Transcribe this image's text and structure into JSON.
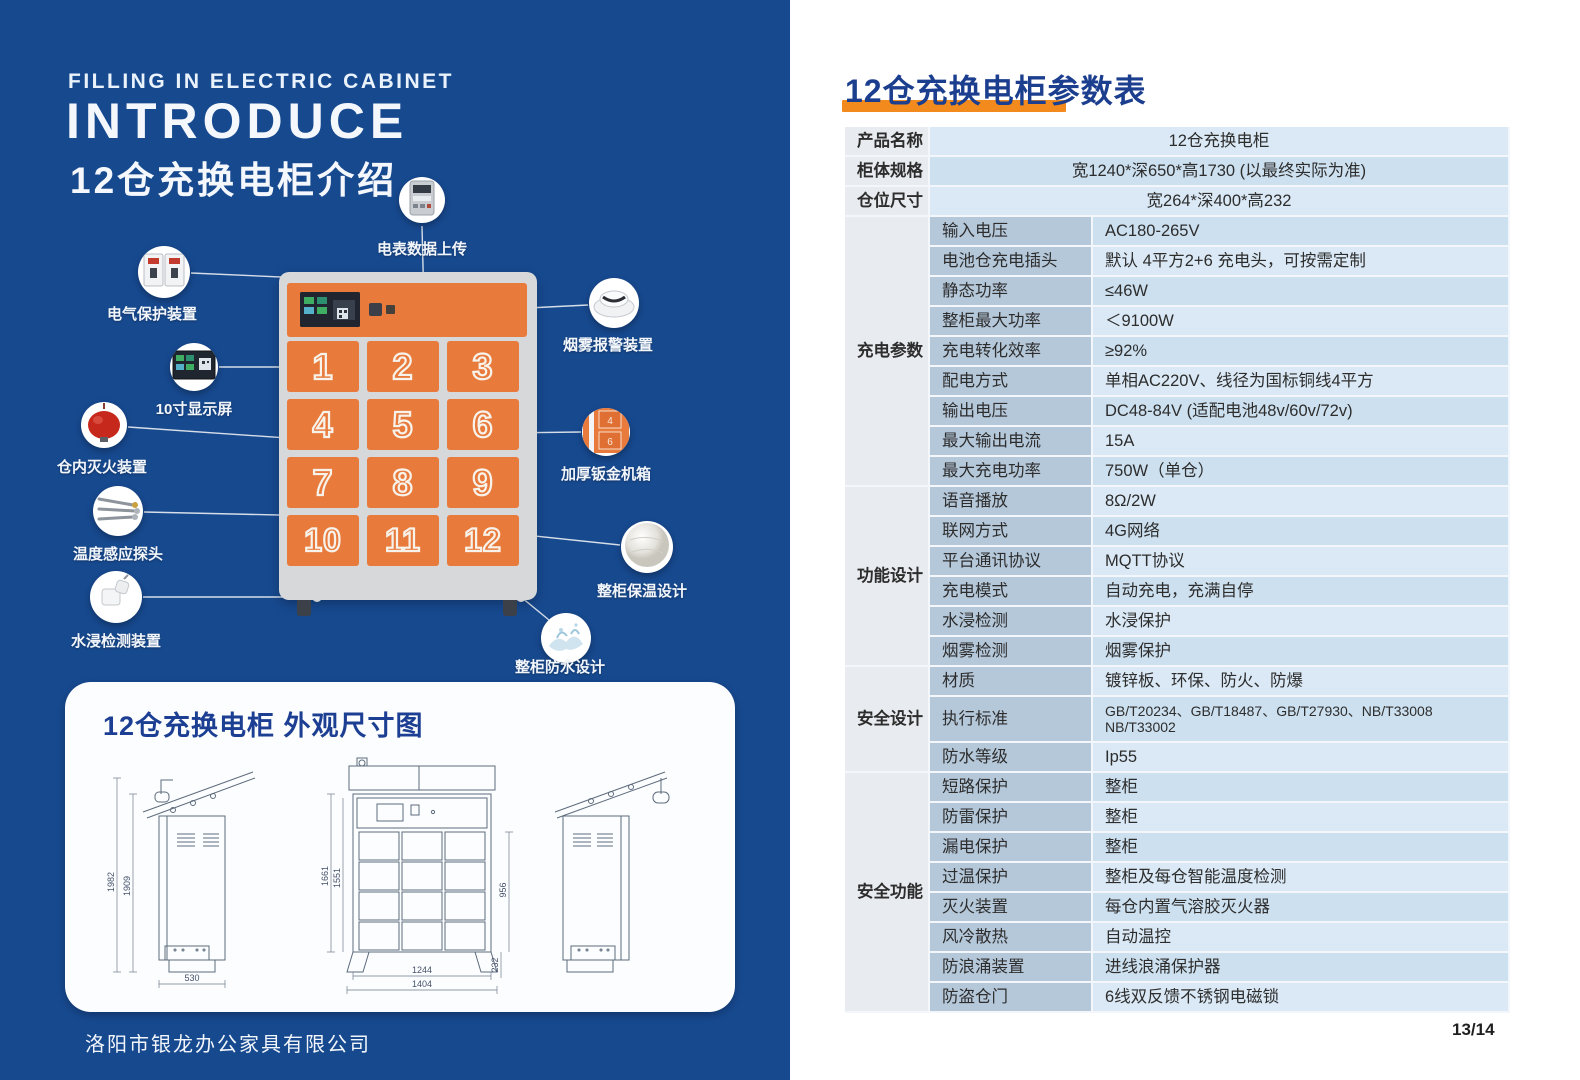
{
  "colors": {
    "panel_blue": "#17498f",
    "door_orange": "#e87a3c",
    "title_blue": "#1c3e8e",
    "underline_orange": "#f28a1e",
    "row_light": "#dae9f5",
    "row_dark": "#cde0ef",
    "label_col": "#b5c8da",
    "group_col": "#e8ebef"
  },
  "left_panel": {
    "eyebrow": "FILLING IN ELECTRIC CABINET",
    "title": "INTRODUCE",
    "subtitle": "12仓充换电柜介绍",
    "company": "洛阳市银龙办公家具有限公司",
    "cabinet": {
      "doors": [
        "1",
        "2",
        "3",
        "4",
        "5",
        "6",
        "7",
        "8",
        "9",
        "10",
        "11",
        "12"
      ]
    },
    "callouts": [
      {
        "id": "meter",
        "icon": "electric-meter-icon",
        "label": "电表数据上传",
        "x": 422,
        "y": 200,
        "r": 23,
        "label_y": 238,
        "label_x": 422,
        "line": [
          [
            424,
            307
          ],
          [
            422,
            226
          ]
        ]
      },
      {
        "id": "breaker",
        "icon": "circuit-breaker-icon",
        "label": "电气保护装置",
        "x": 164,
        "y": 272,
        "r": 26,
        "label_y": 303,
        "label_x": 152,
        "line": [
          [
            303,
            278
          ],
          [
            191,
            273
          ]
        ]
      },
      {
        "id": "display",
        "icon": "display-screen-icon",
        "label": "10寸显示屏",
        "x": 194,
        "y": 367,
        "r": 24,
        "label_y": 398,
        "label_x": 194,
        "line": [
          [
            322,
            307
          ],
          [
            375,
            307
          ],
          [
            375,
            367
          ],
          [
            219,
            367
          ]
        ]
      },
      {
        "id": "extinguisher",
        "icon": "fire-extinguisher-icon",
        "label": "仓内灭火装置",
        "x": 104,
        "y": 425,
        "r": 23,
        "label_y": 456,
        "label_x": 102,
        "line": [
          [
            330,
            441
          ],
          [
            128,
            427
          ]
        ]
      },
      {
        "id": "probe",
        "icon": "temperature-probe-icon",
        "label": "温度感应探头",
        "x": 118,
        "y": 511,
        "r": 25,
        "label_y": 543,
        "label_x": 118,
        "line": [
          [
            322,
            516
          ],
          [
            144,
            512
          ]
        ]
      },
      {
        "id": "watersensor",
        "icon": "water-sensor-icon",
        "label": "水浸检测装置",
        "x": 116,
        "y": 597,
        "r": 26,
        "label_y": 630,
        "label_x": 116,
        "line": [
          [
            317,
            597
          ],
          [
            143,
            597
          ]
        ]
      },
      {
        "id": "smoke",
        "icon": "smoke-alarm-icon",
        "label": "烟雾报警装置",
        "x": 614,
        "y": 303,
        "r": 25,
        "label_y": 334,
        "label_x": 608,
        "line": [
          [
            508,
            309
          ],
          [
            588,
            305
          ]
        ]
      },
      {
        "id": "sheetmetal",
        "icon": "sheet-metal-icon",
        "label": "加厚钣金机箱",
        "x": 606,
        "y": 432,
        "r": 24,
        "label_y": 463,
        "label_x": 606,
        "line": [
          [
            500,
            433
          ],
          [
            581,
            432
          ]
        ]
      },
      {
        "id": "insulation",
        "icon": "insulation-icon",
        "label": "整柜保温设计",
        "x": 647,
        "y": 547,
        "r": 26,
        "label_y": 580,
        "label_x": 642,
        "line": [
          [
            506,
            533
          ],
          [
            620,
            545
          ]
        ]
      },
      {
        "id": "waterproof",
        "icon": "waterproof-icon",
        "label": "整柜防水设计",
        "x": 566,
        "y": 638,
        "r": 25,
        "label_y": 656,
        "label_x": 560,
        "line": [
          [
            521,
            597
          ],
          [
            549,
            620
          ]
        ]
      }
    ],
    "dimension_panel": {
      "title": "12仓充换电柜  外观尺寸图",
      "side": {
        "h_outer": "1982",
        "h_inner": "1909",
        "w": "530"
      },
      "front": {
        "h_outer": "1661",
        "h_inner": "1551",
        "right_h": "956",
        "right_base": "232",
        "w_inner": "1244",
        "w_outer": "1404"
      }
    }
  },
  "right_panel": {
    "title": "12仓充换电柜参数表",
    "page": "13/14",
    "table": {
      "top_rows": [
        {
          "label": "产品名称",
          "value": "12仓充换电柜"
        },
        {
          "label": "柜体规格",
          "value": "宽1240*深650*高1730 (以最终实际为准)"
        },
        {
          "label": "仓位尺寸",
          "value": "宽264*深400*高232"
        }
      ],
      "groups": [
        {
          "name": "充电参数",
          "rows": [
            [
              "输入电压",
              "AC180-265V"
            ],
            [
              "电池仓充电插头",
              "默认 4平方2+6 充电头，可按需定制"
            ],
            [
              "静态功率",
              "≤46W"
            ],
            [
              "整柜最大功率",
              "＜9100W"
            ],
            [
              "充电转化效率",
              "≥92%"
            ],
            [
              "配电方式",
              "单相AC220V、线径为国标铜线4平方"
            ],
            [
              "输出电压",
              "DC48-84V (适配电池48v/60v/72v)"
            ],
            [
              "最大输出电流",
              "15A"
            ],
            [
              "最大充电功率",
              "750W（单仓）"
            ]
          ]
        },
        {
          "name": "功能设计",
          "rows": [
            [
              "语音播放",
              "8Ω/2W"
            ],
            [
              "联网方式",
              "4G网络"
            ],
            [
              "平台通讯协议",
              "MQTT协议"
            ],
            [
              "充电模式",
              "自动充电，充满自停"
            ],
            [
              "水浸检测",
              "水浸保护"
            ],
            [
              "烟雾检测",
              "烟雾保护"
            ]
          ]
        },
        {
          "name": "安全设计",
          "rows": [
            [
              "材质",
              "镀锌板、环保、防火、防爆"
            ],
            [
              "执行标准",
              "GB/T20234、GB/T18487、GB/T27930、NB/T33008\nNB/T33002"
            ],
            [
              "防水等级",
              "Ip55"
            ]
          ]
        },
        {
          "name": "安全功能",
          "rows": [
            [
              "短路保护",
              "整柜"
            ],
            [
              "防雷保护",
              "整柜"
            ],
            [
              "漏电保护",
              "整柜"
            ],
            [
              "过温保护",
              "整柜及每仓智能温度检测"
            ],
            [
              "灭火装置",
              "每仓内置气溶胶灭火器"
            ],
            [
              "风冷散热",
              "自动温控"
            ],
            [
              "防浪涌装置",
              "进线浪涌保护器"
            ],
            [
              "防盗仓门",
              "6线双反馈不锈钢电磁锁"
            ]
          ]
        }
      ]
    }
  }
}
